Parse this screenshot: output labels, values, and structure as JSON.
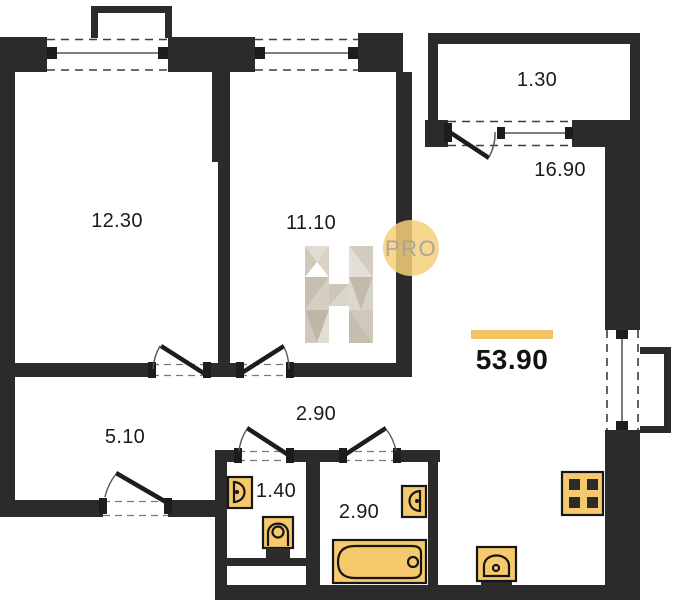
{
  "plan": {
    "type": "apartment-floor-plan",
    "total_area": "53.90",
    "rooms": [
      {
        "id": "bedroom-1",
        "area": "12.30"
      },
      {
        "id": "bedroom-2",
        "area": "11.10"
      },
      {
        "id": "balcony",
        "area": "1.30"
      },
      {
        "id": "kitchen-living-room",
        "area": "16.90"
      },
      {
        "id": "hallway",
        "area": "5.10"
      },
      {
        "id": "corridor",
        "area": "2.90"
      },
      {
        "id": "wc",
        "area": "1.40"
      },
      {
        "id": "bathroom",
        "area": "2.90"
      }
    ],
    "watermark": {
      "letter": "H",
      "badge": "PRO"
    },
    "fixtures": [
      "wc-sink",
      "toilet",
      "bathroom-sink",
      "bathtub",
      "kitchen-sink",
      "stove"
    ],
    "colors": {
      "wall": "#2b2b2b",
      "fixture_fill": "#f6c96d",
      "accent_bar": "#f2c365",
      "badge_fill": "#f6cf79",
      "badge_text": "#a8a69c"
    }
  }
}
